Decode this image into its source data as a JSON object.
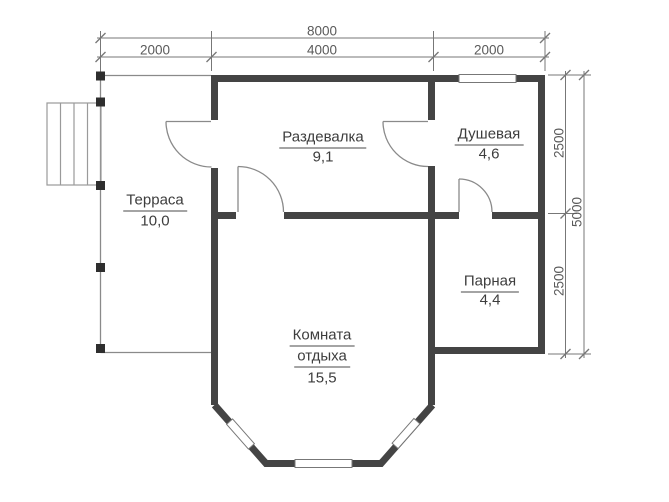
{
  "rooms": {
    "terrace": {
      "label": "Терраса",
      "area": "10,0"
    },
    "dressing_room": {
      "label": "Раздевалка",
      "area": "9,1"
    },
    "shower": {
      "label": "Душевая",
      "area": "4,6"
    },
    "steam_room": {
      "label": "Парная",
      "area": "4,4"
    },
    "rest_room": {
      "label_line1": "Комната",
      "label_line2": "отдыха",
      "area": "15,5"
    }
  },
  "dimensions": {
    "total_width": "8000",
    "terrace_width": "2000",
    "dressing_width": "4000",
    "shower_width": "2000",
    "upper_right_height": "2500",
    "lower_right_height": "2500",
    "total_height": "5000"
  },
  "colors": {
    "wall": "#444444",
    "thin_line": "#8a8a8a",
    "dimension_line": "#777777",
    "post": "#2e2e2e",
    "room_text": "#3d3d3d",
    "dimension_text": "#5a5a5a",
    "background": "#ffffff"
  }
}
